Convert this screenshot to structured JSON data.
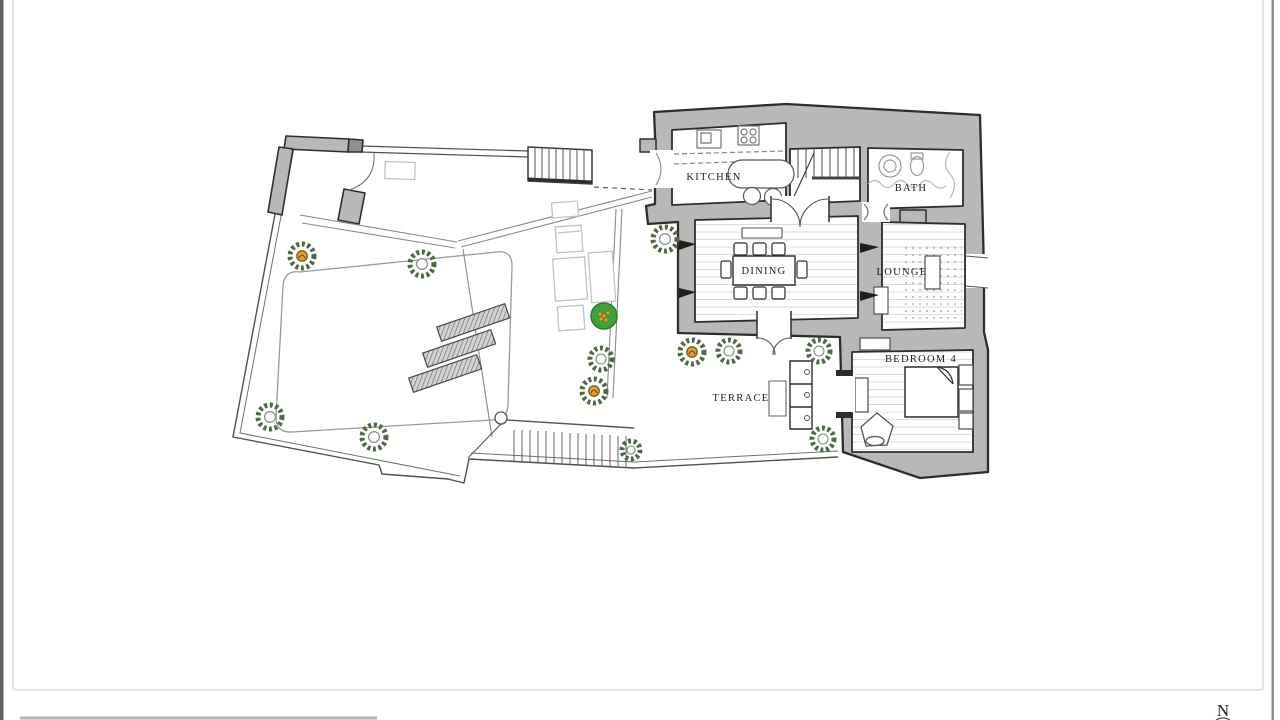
{
  "canvas": {
    "width": 1280,
    "height": 720,
    "background": "#ffffff"
  },
  "frame": {
    "left_strip_color": "#616161",
    "right_strip_color": "#8f8f8f",
    "border_color": "#e4e4e4",
    "bottom_edge_color": "#b3b3b3"
  },
  "compass": {
    "label": "N",
    "icon": "compass-north-icon"
  },
  "plan": {
    "type": "floor-plan",
    "colors": {
      "wall_fill": "#b8b8b8",
      "wall_stroke": "#2d2d2d",
      "floor_line": "#dcdcdc",
      "boundary": "#4f4f4f",
      "path_line": "#8a8a8a",
      "furniture_light": "#c2c2c2",
      "fixture": "#777777",
      "plant_ring": "#4e6a42",
      "plant_inner": "#8b8b8b",
      "plant_accent": "#e2a02f",
      "bush_fill": "#3fa239",
      "bush_stroke": "#2c7d22"
    },
    "rooms": [
      {
        "id": "kitchen",
        "label": "KITCHEN",
        "label_x": 714,
        "label_y": 180
      },
      {
        "id": "bath",
        "label": "BATH",
        "label_x": 911,
        "label_y": 191
      },
      {
        "id": "dining",
        "label": "DINING",
        "label_x": 764,
        "label_y": 274
      },
      {
        "id": "lounge",
        "label": "LOUNGE",
        "label_x": 902,
        "label_y": 275
      },
      {
        "id": "terrace",
        "label": "TERRACE",
        "label_x": 741,
        "label_y": 401
      },
      {
        "id": "bedroom4",
        "label": "BEDROOM 4",
        "label_x": 921,
        "label_y": 362
      }
    ],
    "plants": [
      {
        "type": "accent",
        "x": 302,
        "y": 256,
        "r": 12
      },
      {
        "type": "ring",
        "x": 422,
        "y": 264,
        "r": 12
      },
      {
        "type": "ring",
        "x": 270,
        "y": 417,
        "r": 12
      },
      {
        "type": "ring",
        "x": 374,
        "y": 437,
        "r": 12
      },
      {
        "type": "ring",
        "x": 665,
        "y": 239,
        "r": 12
      },
      {
        "type": "bush",
        "x": 604,
        "y": 316,
        "r": 13
      },
      {
        "type": "ring",
        "x": 601,
        "y": 359,
        "r": 11
      },
      {
        "type": "accent",
        "x": 594,
        "y": 391,
        "r": 12
      },
      {
        "type": "ring",
        "x": 631,
        "y": 450,
        "r": 9
      },
      {
        "type": "accent",
        "x": 692,
        "y": 352,
        "r": 12
      },
      {
        "type": "ring",
        "x": 729,
        "y": 351,
        "r": 11
      },
      {
        "type": "ring",
        "x": 819,
        "y": 351,
        "r": 11
      },
      {
        "type": "ring",
        "x": 823,
        "y": 439,
        "r": 11
      }
    ]
  }
}
